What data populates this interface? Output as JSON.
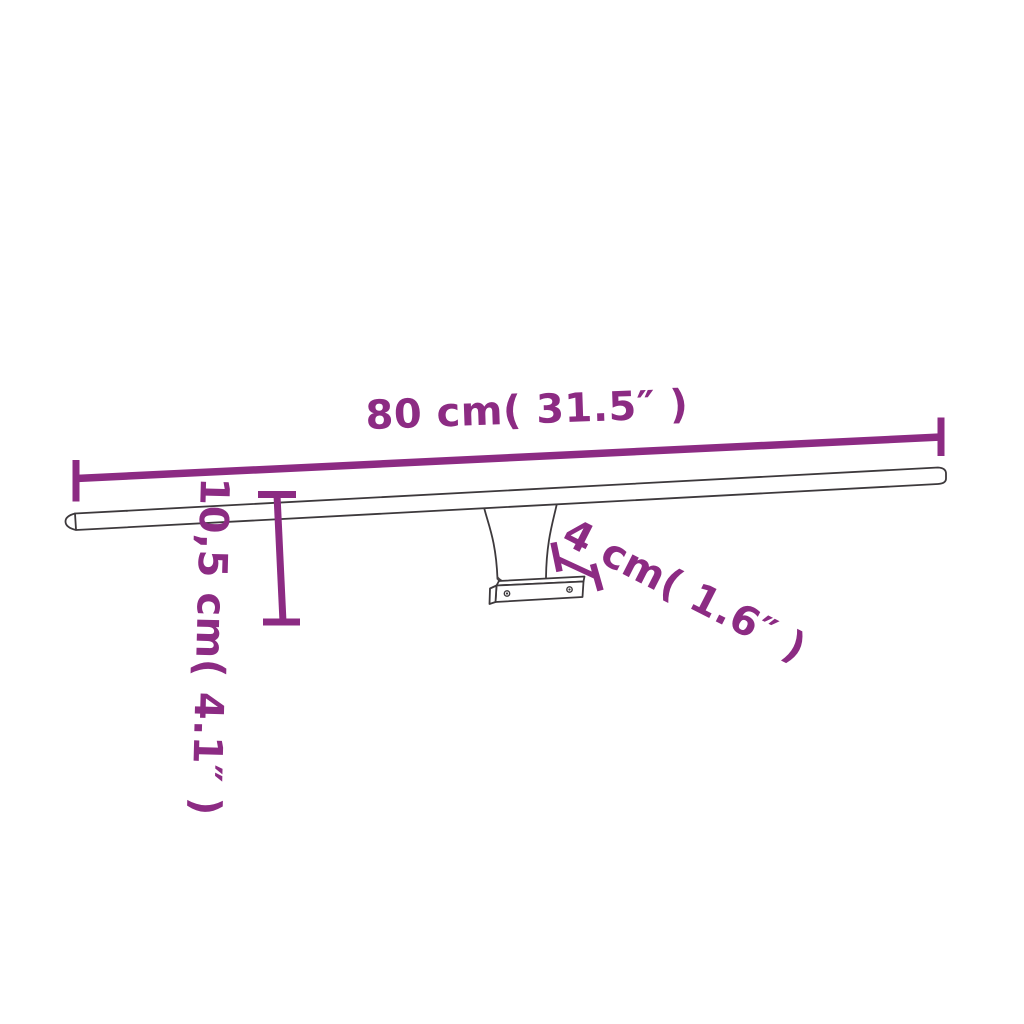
{
  "diagram": {
    "kind": "product-dimension-diagram",
    "subject": "wall-mounted-led-light-bar",
    "labels": {
      "width": "80 cm( 31.5″ )",
      "height": "10,5 cm( 4.1″ )",
      "depth": "4 cm( 1.6″ )"
    }
  },
  "colors": {
    "accent": "#8C2B83",
    "outline": "#3d393c",
    "background": "#ffffff",
    "screw": "#3d393c"
  }
}
